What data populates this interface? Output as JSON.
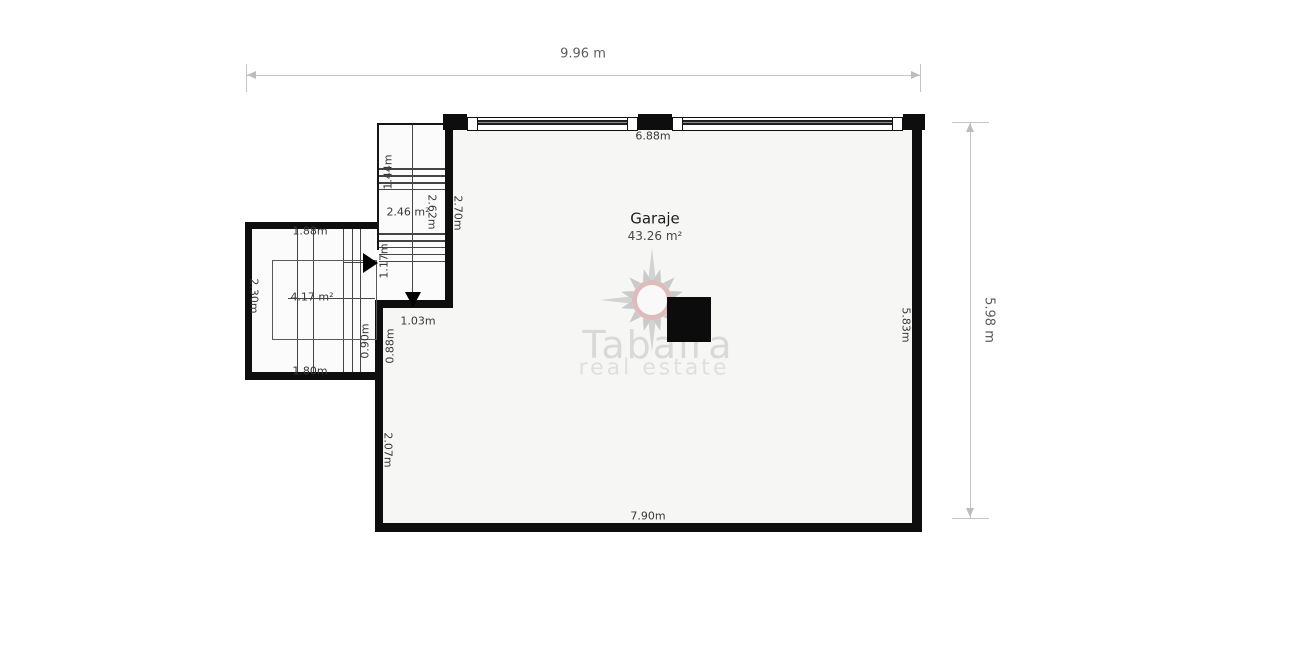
{
  "plan": {
    "garage": {
      "name": "Garaje",
      "area": "43.26 m²"
    },
    "stairwell": {
      "area": "2.46 m²"
    },
    "left_room": {
      "area": "4.17 m²"
    }
  },
  "dimensions": {
    "overall_width": "9.96 m",
    "overall_height": "5.98 m",
    "garage_top_inner": "6.88m",
    "garage_bottom_inner": "7.90m",
    "garage_right_inner": "5.83m",
    "garage_left_lower": "2.07m",
    "stair_opening": "1.03m",
    "stair_height": "2.70m",
    "stair_inner_height": "2.62m",
    "stair_upper_flight": "1.44m",
    "stair_lower_flight": "1.17m",
    "left_room_top": "1.88m",
    "left_room_side": "2.30m",
    "left_room_bottom": "1.80m",
    "wall_segment_left": "0.90m",
    "wall_segment_right": "0.88m"
  },
  "watermark": {
    "title": "Tabaira",
    "subtitle": "real estate"
  },
  "colors": {
    "wall": "#0e0e0e",
    "garage_floor": "#f6f6f5",
    "dimension_line": "#c4c4c4",
    "watermark_gray": "#d9d9d9",
    "watermark_ring_pink": "#dcbcbc"
  }
}
